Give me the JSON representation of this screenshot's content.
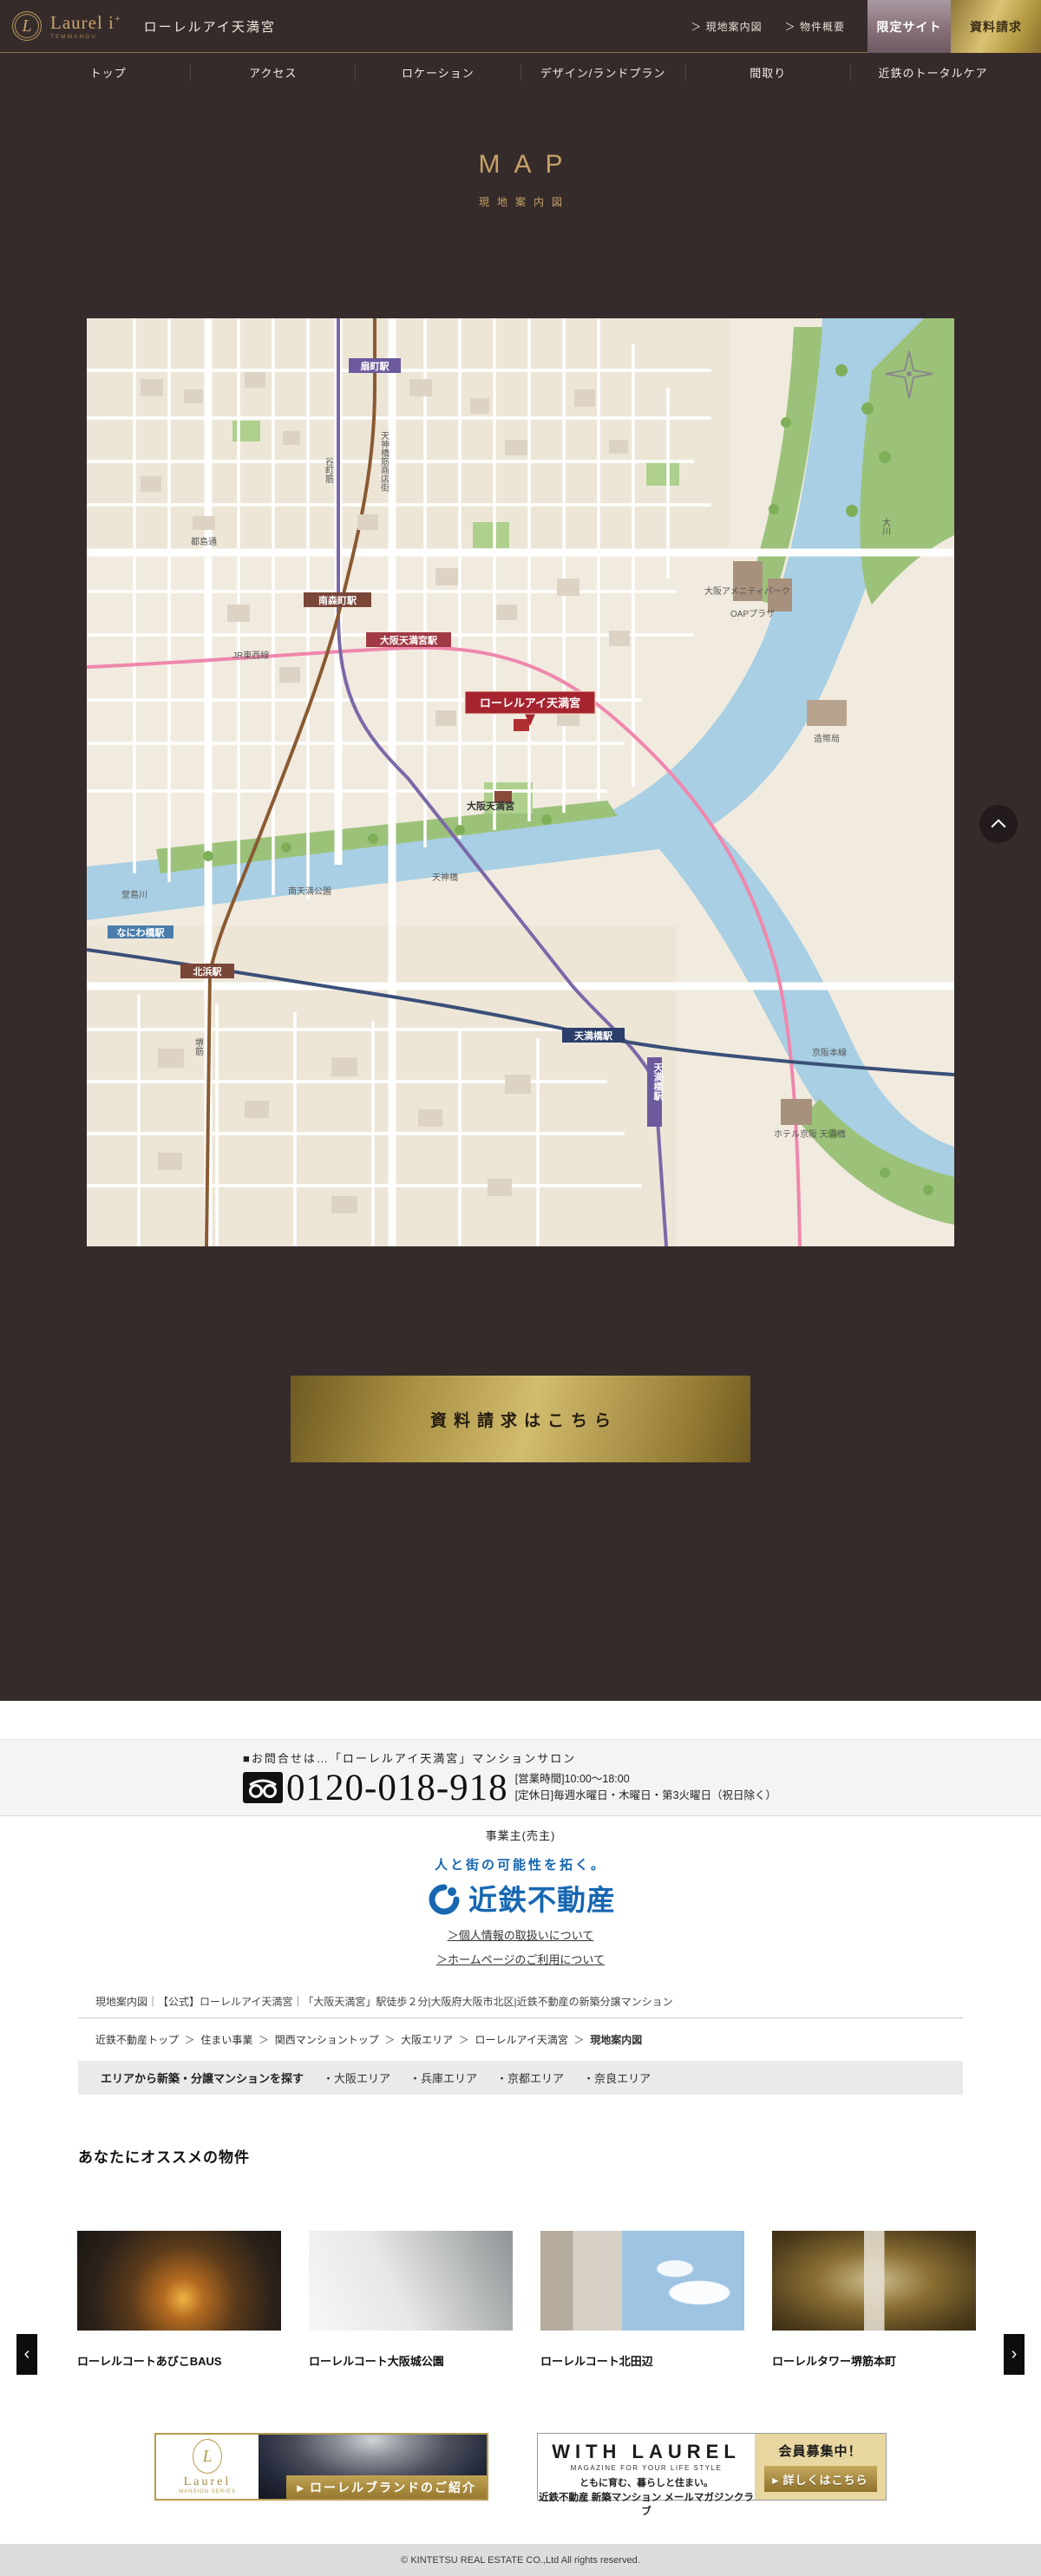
{
  "header": {
    "logo_initial": "L",
    "brand": "Laurel i",
    "brand_plus": "+",
    "brand_sub": "TEMMANGU",
    "property_name": "ローレルアイ天満宮",
    "links": {
      "map": "＞ 現地案内図",
      "outline": "＞ 物件概要"
    },
    "buttons": {
      "limited": "限定サイト",
      "request": "資料請求"
    }
  },
  "nav": {
    "items": [
      "トップ",
      "アクセス",
      "ロケーション",
      "デザイン/ランドプラン",
      "間取り",
      "近鉄のトータルケア"
    ]
  },
  "hero": {
    "title": "MAP",
    "subtitle": "現地案内図"
  },
  "map": {
    "property_badge": "ローレルアイ天満宮",
    "stations": [
      {
        "label": "扇町駅"
      },
      {
        "label": "南森町駅"
      },
      {
        "label": "大阪天満宮駅"
      },
      {
        "label": "北浜駅"
      },
      {
        "label": "天満橋駅"
      },
      {
        "label": "天満橋駅"
      },
      {
        "label": "なにわ橋駅"
      }
    ],
    "labels": {
      "shrine": "大阪天満宮",
      "bridge": "天神橋",
      "park": "南天満公園",
      "river_main": "大川",
      "river_west": "堂島川",
      "oap1": "大阪アメニティパーク",
      "oap2": "OAPプラザ",
      "mint": "造幣局",
      "road_miyakojima": "都島通",
      "road_tenjinbashisuji": "天神橋筋商店街",
      "road_tanimachisuji": "谷町筋",
      "road_sakaisuji": "堺筋",
      "line_keihan": "京阪本線",
      "line_jr": "JR東西線",
      "hotel": "ホテル京阪 天満橋"
    }
  },
  "cta": {
    "label": "資料請求はこちら"
  },
  "contact": {
    "heading": "■お問合せは…「ローレルアイ天満宮」マンションサロン",
    "phone": "0120-018-918",
    "hours": "[営業時間]10:00～18:00",
    "holiday": "[定休日]毎週水曜日・木曜日・第3火曜日（祝日除く）"
  },
  "company": {
    "label": "事業主(売主)",
    "slogan": "人と街の可能性を拓く。",
    "name": "近鉄不動産",
    "link_privacy": "＞個人情報の取扱いについて",
    "link_terms": "＞ホームページのご利用について"
  },
  "breadcrumb": {
    "title_line": "現地案内図｜【公式】ローレルアイ天満宮｜「大阪天満宮」駅徒歩２分|大阪府大阪市北区|近鉄不動産の新築分譲マンション",
    "path": [
      "近鉄不動産トップ",
      "住まい事業",
      "関西マンショントップ",
      "大阪エリア",
      "ローレルアイ天満宮",
      "現地案内図"
    ]
  },
  "area_search": {
    "label": "エリアから新築・分譲マンションを探す",
    "areas": [
      "・大阪エリア",
      "・兵庫エリア",
      "・京都エリア",
      "・奈良エリア"
    ]
  },
  "recommend": {
    "heading": "あなたにオススメの物件",
    "items": [
      {
        "name": "ローレルコートあびこBAUS"
      },
      {
        "name": "ローレルコート大阪城公園"
      },
      {
        "name": "ローレルコート北田辺"
      },
      {
        "name": "ローレルタワー堺筋本町"
      }
    ],
    "prev": "‹",
    "next": "›"
  },
  "banners": {
    "laurel": {
      "initial": "L",
      "name": "Laurel",
      "sub": "MANSION SERIES",
      "ribbon": "▸ ローレルブランドのご紹介"
    },
    "with_laurel": {
      "title": "WITH LAUREL",
      "subtitle": "MAGAZINE FOR YOUR LIFE STYLE",
      "line1": "ともに育む、暮らしと住まい。",
      "line2": "近鉄不動産 新築マンション メールマガジンクラブ",
      "badge": "会員募集中！",
      "button": "▸ 詳しくはこちら"
    }
  },
  "footer": {
    "copyright": "© KINTETSU REAL ESTATE CO.,Ltd All rights reserved."
  }
}
